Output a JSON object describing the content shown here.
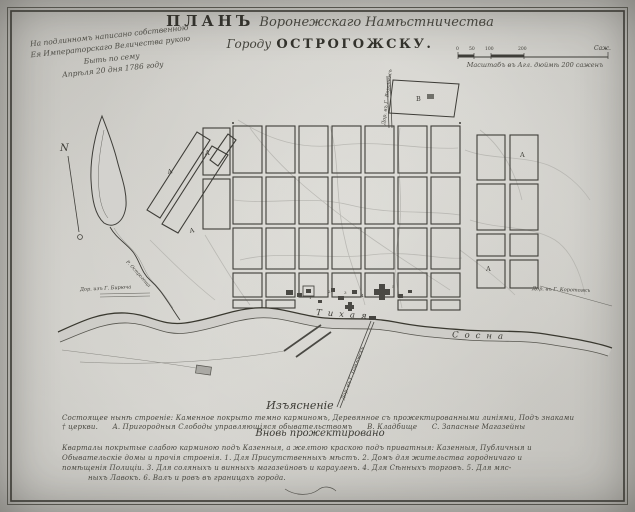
{
  "title": {
    "plan": "ПЛАНЪ",
    "region": "Воронежскаго Намѣстничества",
    "city_prefix": "Городу",
    "city_name": "ОСТРОГОЖСКУ."
  },
  "approval": {
    "line1": "На подлинномъ написано собственною",
    "line2": "Ея Императорскаго Величества рукою",
    "line3": "Быть по сему",
    "line4": "Апрѣля 20 дня 1786 году"
  },
  "scale_bar": {
    "ticks": [
      "0",
      "50",
      "100",
      "200"
    ],
    "unit_label": "Саж.",
    "caption": "Масштабъ въ Агл. дюймѣ 200 саженъ"
  },
  "map": {
    "north_letter": "N",
    "river_name_1": "Тихая",
    "river_name_2": "Сосна",
    "stream_name": "Р. Острогоща",
    "road_west": "Дор. изъ Г. Бирюча",
    "road_east": "Дор. въ Г. Коротоякъ",
    "road_north": "Дор. въ Г. Воронежъ",
    "road_south": "Дор. въ Г. Павловскъ",
    "letter_a": "A",
    "letter_b": "B",
    "building_numbers": [
      "1",
      "2",
      "3",
      "4",
      "5"
    ]
  },
  "legend": {
    "header": "Изъясненіе",
    "para1_line1": "Состоящее нынѣ строеніе: Каменное покрыто темно карминомъ, Деревянное съ прожектированными линіями, Подъ знаками",
    "para1_line2": "† церкви.      A. Пригородныя Слободы управляющіяся обывательствомъ      B. Кладбище      C. Запасные Магазейны",
    "subheader": "Вновь прожектировано",
    "para2_line1": "Кварталы покрытые слабою карминою подъ Казенныя, а желтою краскою подъ приватныя: Казенныя, Публичныя и",
    "para2_line2": "Обывательскіе домы и прочія строенія. 1. Для Присутственныхъ мѣстъ. 2. Домъ для жительства городничаго и",
    "para2_line3": "помѣщенія Полиціи. 3. Для соляныхъ и винныхъ магазейновъ и карауленъ. 4. Для Сѣнныхъ торговъ. 5. Для мяс-",
    "para2_line4": "ныхъ Лавокъ. 6. Валъ и ровъ въ границахъ города."
  }
}
